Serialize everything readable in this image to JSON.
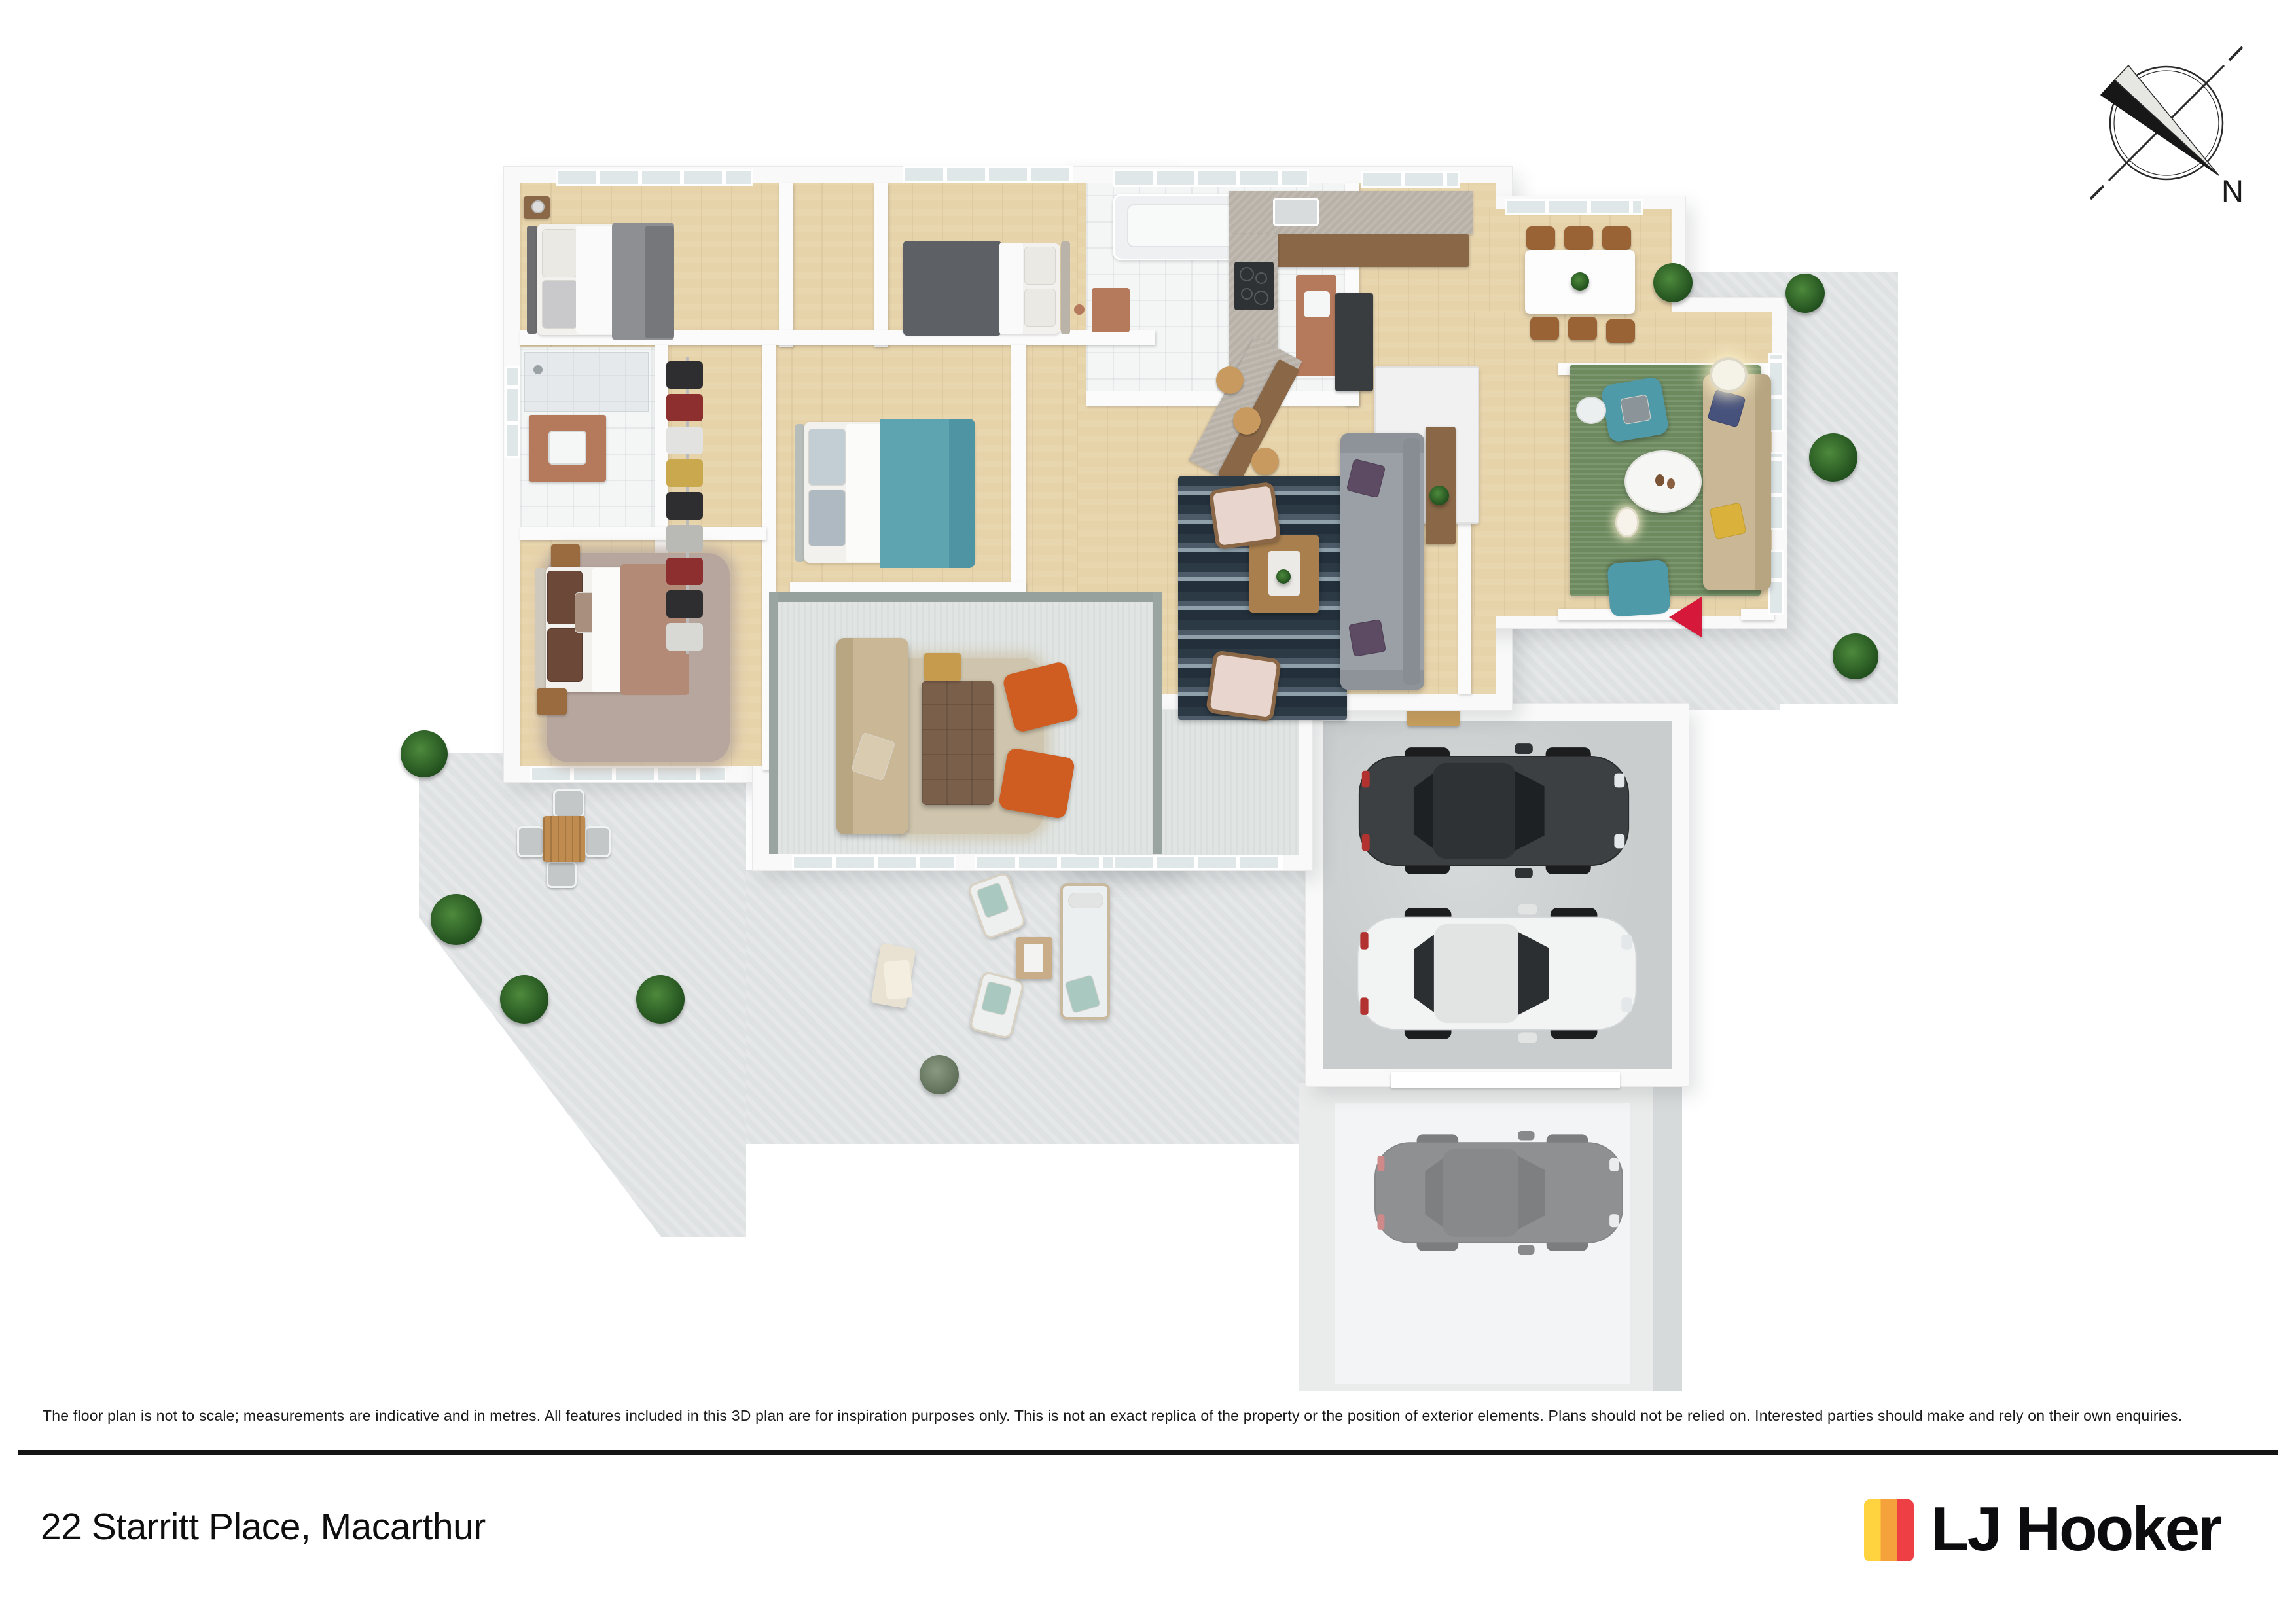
{
  "page": {
    "background": "#FFFFFF"
  },
  "compass": {
    "label": "N"
  },
  "footer": {
    "disclaimer": "The floor plan is not to scale; measurements are indicative and in metres. All features included in this 3D plan are for inspiration purposes only. This is not an exact replica of the property or the position of exterior elements. Plans should not be relied on. Interested parties should make and rely on their own enquiries.",
    "address": "22 Starritt Place, Macarthur"
  },
  "brand": {
    "name": "LJ Hooker"
  },
  "palette": {
    "ink": "#141414",
    "wall": "#F9F9F9",
    "wood": "#E7D3AA",
    "wood_dark": "#8A6847",
    "patio": "#DFE2E3",
    "garage_floor": "#C9CDCE",
    "carpet": "#E0E4E2",
    "tile": "#F4F6F6",
    "rug_green": "#6D8A5F",
    "rug_beige": "#CFC5AE",
    "rug_mauve": "#B7A69D",
    "sofa_gray": "#9AA0A5",
    "sofa_beige": "#C9B795",
    "chair_orange": "#CF5C20",
    "chair_teal": "#4F9AA8",
    "bed_teal": "#5DA3B0",
    "bed_dark": "#5D6064",
    "bed_gray": "#8D8F93",
    "bed_rose": "#B38A76",
    "copper": "#B5795C",
    "car_dark": "#3D4043",
    "car_white": "#F2F3F3",
    "marker_red": "#D6193A",
    "logo_yellow": "#FFD23F",
    "logo_orange": "#F5A23C",
    "logo_red": "#EE4044"
  }
}
